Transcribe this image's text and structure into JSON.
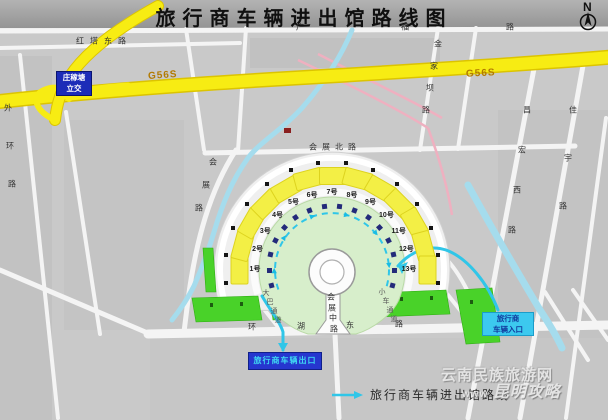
{
  "title": "旅行商车辆进出馆路线图",
  "compass": {
    "label": "N"
  },
  "expressway": {
    "label": "G56S"
  },
  "interchange": {
    "line1": "庄稼塘",
    "line2": "立交"
  },
  "roads": {
    "hongta": "红塔东路",
    "guangfu": "广福路",
    "huizhanbei": "会展北路",
    "huizhanzhong": "会展中路",
    "huanhudong": "环湖东路",
    "huizhan": "会展路",
    "jinjiaba": "金家坝路",
    "changhongxi": "昌宏西路",
    "jiayu": "佳宇路",
    "waihuan": "外环路",
    "daba": "大巴通道",
    "xiaoche": "小车通道"
  },
  "halls": [
    "1号",
    "2号",
    "3号",
    "4号",
    "5号",
    "6号",
    "7号",
    "8号",
    "9号",
    "10号",
    "11号",
    "12号",
    "13号"
  ],
  "entry_box": {
    "line1": "旅行商",
    "line2": "车辆入口"
  },
  "exit_box": {
    "label": "旅行商车辆出口"
  },
  "legend": {
    "label": "旅行商车辆进出馆路线"
  },
  "watermark": {
    "line1": "云南民族旅游网",
    "line2_prefix": "www",
    "line2": "昆明攻略"
  },
  "colors": {
    "expressway_yellow": "#f7ec13",
    "route_cyan": "#30c6e8",
    "hall_yellow": "#f3ef45",
    "plaza_green": "#d7eecb",
    "strip_green": "#49d229",
    "box_blue": "#2636cf",
    "entry_cyan": "#3cc9ef",
    "river_blue": "#a5dced"
  }
}
